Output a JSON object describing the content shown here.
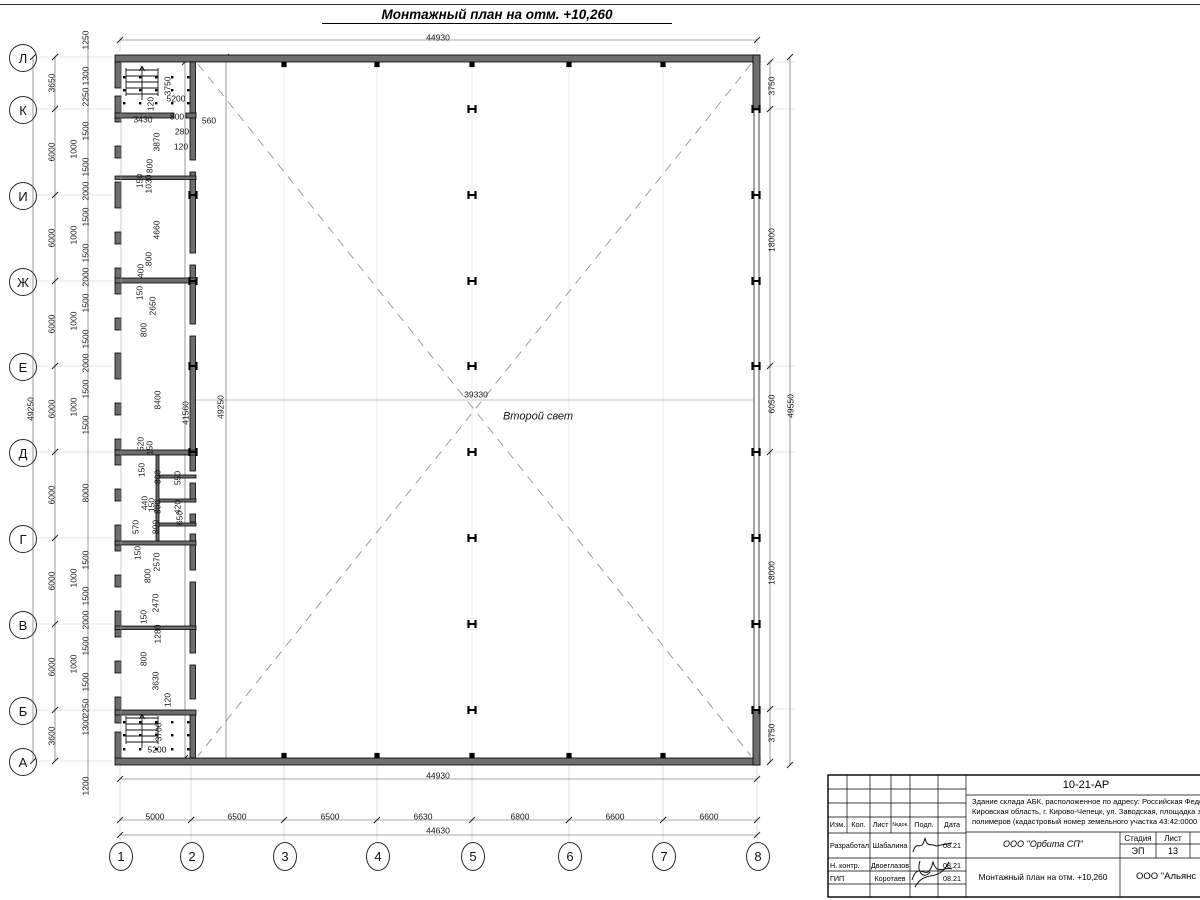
{
  "title": "Монтажный план на отм. +10,260",
  "colors": {
    "line": "#000000",
    "wall_fill": "#6e6e6e",
    "dim_text": "#141414",
    "light_line": "#c9c9c9",
    "dash": "#999999"
  },
  "second_light_label": "Второй свет",
  "plan": {
    "axis_rows": [
      {
        "l": "Л",
        "y": 57
      },
      {
        "l": "К",
        "y": 109
      },
      {
        "l": "И",
        "y": 195
      },
      {
        "l": "Ж",
        "y": 281
      },
      {
        "l": "Е",
        "y": 366
      },
      {
        "l": "Д",
        "y": 452
      },
      {
        "l": "Г",
        "y": 538
      },
      {
        "l": "В",
        "y": 624
      },
      {
        "l": "Б",
        "y": 710
      },
      {
        "l": "А",
        "y": 761
      }
    ],
    "axis_cols": [
      {
        "l": "1",
        "x": 120
      },
      {
        "l": "2",
        "x": 191
      },
      {
        "l": "3",
        "x": 284
      },
      {
        "l": "4",
        "x": 377
      },
      {
        "l": "5",
        "x": 472
      },
      {
        "l": "6",
        "x": 569
      },
      {
        "l": "7",
        "x": 663
      },
      {
        "l": "8",
        "x": 757
      }
    ],
    "labels": [
      {
        "t": "44930",
        "x": 438,
        "y": 38
      },
      {
        "t": "44930",
        "x": 438,
        "y": 776
      },
      {
        "t": "5000",
        "x": 155,
        "y": 817
      },
      {
        "t": "6500",
        "x": 237,
        "y": 817
      },
      {
        "t": "6500",
        "x": 330,
        "y": 817
      },
      {
        "t": "6630",
        "x": 423,
        "y": 817
      },
      {
        "t": "6800",
        "x": 520,
        "y": 817
      },
      {
        "t": "6600",
        "x": 615,
        "y": 817
      },
      {
        "t": "6600",
        "x": 709,
        "y": 817
      },
      {
        "t": "44630",
        "x": 438,
        "y": 831
      },
      {
        "t": "49250",
        "x": 31,
        "y": 409,
        "r": -90
      },
      {
        "t": "3650",
        "x": 52,
        "y": 83,
        "r": -90
      },
      {
        "t": "6000",
        "x": 52,
        "y": 152,
        "r": -90
      },
      {
        "t": "6000",
        "x": 52,
        "y": 238,
        "r": -90
      },
      {
        "t": "6000",
        "x": 52,
        "y": 324,
        "r": -90
      },
      {
        "t": "6000",
        "x": 52,
        "y": 409,
        "r": -90
      },
      {
        "t": "6000",
        "x": 52,
        "y": 495,
        "r": -90
      },
      {
        "t": "6000",
        "x": 52,
        "y": 581,
        "r": -90
      },
      {
        "t": "6000",
        "x": 52,
        "y": 667,
        "r": -90
      },
      {
        "t": "3600",
        "x": 52,
        "y": 736,
        "r": -90
      },
      {
        "t": "1250",
        "x": 86,
        "y": 40,
        "r": -90
      },
      {
        "t": "1300",
        "x": 86,
        "y": 76,
        "r": -90
      },
      {
        "t": "2250",
        "x": 86,
        "y": 97,
        "r": -90
      },
      {
        "t": "1500",
        "x": 86,
        "y": 131,
        "r": -90
      },
      {
        "t": "1000",
        "x": 74,
        "y": 149,
        "r": -90
      },
      {
        "t": "1500",
        "x": 86,
        "y": 167,
        "r": -90
      },
      {
        "t": "2000",
        "x": 86,
        "y": 191,
        "r": -90
      },
      {
        "t": "1500",
        "x": 86,
        "y": 217,
        "r": -90
      },
      {
        "t": "1000",
        "x": 74,
        "y": 235,
        "r": -90
      },
      {
        "t": "1500",
        "x": 86,
        "y": 253,
        "r": -90
      },
      {
        "t": "2000",
        "x": 86,
        "y": 277,
        "r": -90
      },
      {
        "t": "1500",
        "x": 86,
        "y": 303,
        "r": -90
      },
      {
        "t": "1000",
        "x": 74,
        "y": 321,
        "r": -90
      },
      {
        "t": "1500",
        "x": 86,
        "y": 339,
        "r": -90
      },
      {
        "t": "2000",
        "x": 86,
        "y": 363,
        "r": -90
      },
      {
        "t": "1500",
        "x": 86,
        "y": 389,
        "r": -90
      },
      {
        "t": "1000",
        "x": 74,
        "y": 407,
        "r": -90
      },
      {
        "t": "1500",
        "x": 86,
        "y": 425,
        "r": -90
      },
      {
        "t": "8000",
        "x": 86,
        "y": 493,
        "r": -90
      },
      {
        "t": "1500",
        "x": 86,
        "y": 560,
        "r": -90
      },
      {
        "t": "1000",
        "x": 74,
        "y": 578,
        "r": -90
      },
      {
        "t": "1500",
        "x": 86,
        "y": 596,
        "r": -90
      },
      {
        "t": "2000",
        "x": 86,
        "y": 620,
        "r": -90
      },
      {
        "t": "1500",
        "x": 86,
        "y": 646,
        "r": -90
      },
      {
        "t": "1000",
        "x": 74,
        "y": 664,
        "r": -90
      },
      {
        "t": "1500",
        "x": 86,
        "y": 682,
        "r": -90
      },
      {
        "t": "2250",
        "x": 86,
        "y": 708,
        "r": -90
      },
      {
        "t": "1300",
        "x": 86,
        "y": 726,
        "r": -90
      },
      {
        "t": "1200",
        "x": 86,
        "y": 786,
        "r": -90
      },
      {
        "t": "3750",
        "x": 168,
        "y": 86,
        "r": -90
      },
      {
        "t": "5200",
        "x": 176,
        "y": 99
      },
      {
        "t": "120",
        "x": 151,
        "y": 104,
        "r": -90
      },
      {
        "t": "3430",
        "x": 143,
        "y": 120
      },
      {
        "t": "800",
        "x": 177,
        "y": 117
      },
      {
        "t": "280",
        "x": 182,
        "y": 132
      },
      {
        "t": "120",
        "x": 181,
        "y": 147
      },
      {
        "t": "560",
        "x": 209,
        "y": 121
      },
      {
        "t": "3870",
        "x": 157,
        "y": 142,
        "r": -90
      },
      {
        "t": "800",
        "x": 150,
        "y": 166,
        "r": -90
      },
      {
        "t": "150",
        "x": 140,
        "y": 181,
        "r": -90
      },
      {
        "t": "1030",
        "x": 149,
        "y": 184,
        "r": -90
      },
      {
        "t": "4660",
        "x": 157,
        "y": 230,
        "r": -90
      },
      {
        "t": "800",
        "x": 149,
        "y": 259,
        "r": -90
      },
      {
        "t": "400",
        "x": 141,
        "y": 271,
        "r": -90
      },
      {
        "t": "150",
        "x": 140,
        "y": 293,
        "r": -90
      },
      {
        "t": "2650",
        "x": 153,
        "y": 306,
        "r": -90
      },
      {
        "t": "800",
        "x": 144,
        "y": 330,
        "r": -90
      },
      {
        "t": "8400",
        "x": 158,
        "y": 400,
        "r": -90
      },
      {
        "t": "41560",
        "x": 186,
        "y": 413,
        "r": -90
      },
      {
        "t": "49250",
        "x": 221,
        "y": 407,
        "r": -90
      },
      {
        "t": "520",
        "x": 141,
        "y": 444,
        "r": -90
      },
      {
        "t": "150",
        "x": 150,
        "y": 448,
        "r": -90
      },
      {
        "t": "150",
        "x": 142,
        "y": 470,
        "r": -90
      },
      {
        "t": "800",
        "x": 158,
        "y": 477,
        "r": -90
      },
      {
        "t": "550",
        "x": 178,
        "y": 478,
        "r": -90
      },
      {
        "t": "440",
        "x": 145,
        "y": 503,
        "r": -90
      },
      {
        "t": "150",
        "x": 152,
        "y": 505,
        "r": -90
      },
      {
        "t": "800",
        "x": 158,
        "y": 507,
        "r": -90
      },
      {
        "t": "420",
        "x": 178,
        "y": 507,
        "r": -90
      },
      {
        "t": "570",
        "x": 136,
        "y": 527,
        "r": -90
      },
      {
        "t": "800",
        "x": 156,
        "y": 527,
        "r": -90
      },
      {
        "t": "650",
        "x": 180,
        "y": 518,
        "r": -90
      },
      {
        "t": "150",
        "x": 138,
        "y": 553,
        "r": -90
      },
      {
        "t": "2570",
        "x": 157,
        "y": 562,
        "r": -90
      },
      {
        "t": "800",
        "x": 148,
        "y": 576,
        "r": -90
      },
      {
        "t": "2470",
        "x": 156,
        "y": 603,
        "r": -90
      },
      {
        "t": "150",
        "x": 144,
        "y": 617,
        "r": -90
      },
      {
        "t": "1280",
        "x": 158,
        "y": 634,
        "r": -90
      },
      {
        "t": "800",
        "x": 144,
        "y": 659,
        "r": -90
      },
      {
        "t": "3630",
        "x": 156,
        "y": 681,
        "r": -90
      },
      {
        "t": "120",
        "x": 168,
        "y": 700,
        "r": -90
      },
      {
        "t": "3700",
        "x": 159,
        "y": 732,
        "r": -90
      },
      {
        "t": "5200",
        "x": 157,
        "y": 750
      },
      {
        "t": "3750",
        "x": 772,
        "y": 86,
        "r": -90
      },
      {
        "t": "18000",
        "x": 772,
        "y": 240,
        "r": -90
      },
      {
        "t": "6050",
        "x": 772,
        "y": 404,
        "r": -90
      },
      {
        "t": "49550",
        "x": 791,
        "y": 406,
        "r": -90
      },
      {
        "t": "18000",
        "x": 772,
        "y": 573,
        "r": -90
      },
      {
        "t": "3750",
        "x": 772,
        "y": 733,
        "r": -90
      },
      {
        "t": "39330",
        "x": 476,
        "y": 395
      },
      {
        "t": "Второй свет",
        "x": 538,
        "y": 417,
        "fs": 11,
        "it": 1,
        "n": "second-light-label"
      }
    ]
  },
  "titleblock": {
    "doc_number": "10-21-АР",
    "desc1": "Здание склада АБК, расположенное по адресу: Российская Феде",
    "desc2": "Кировская область, г. Кирово-Чепецк, ул. Заводская, площадка з",
    "desc3": "полимеров (кадастровый номер земельного участка 43:42:0000",
    "header": [
      "Изм.",
      "Кол.",
      "Лист",
      "№док.",
      "Подп.",
      "Дата"
    ],
    "sig_rows": [
      {
        "role": "Разработал",
        "name": "Шабалина",
        "date": "08.21"
      },
      {
        "role": "Н. контр.",
        "name": "Двоеглазов",
        "date": "08.21"
      },
      {
        "role": "ГИП",
        "name": "Коротаев",
        "date": "08.21"
      }
    ],
    "org1": "ООО \"Орбита СП\"",
    "stage_label": "Стадия",
    "sheet_label": "Лист",
    "sheets_label": "Ли",
    "stage": "ЭП",
    "sheet": "13",
    "sheets": "1",
    "drawing_name": "Монтажный план на отм. +10,260",
    "org2": "ООО \"Альянс"
  }
}
